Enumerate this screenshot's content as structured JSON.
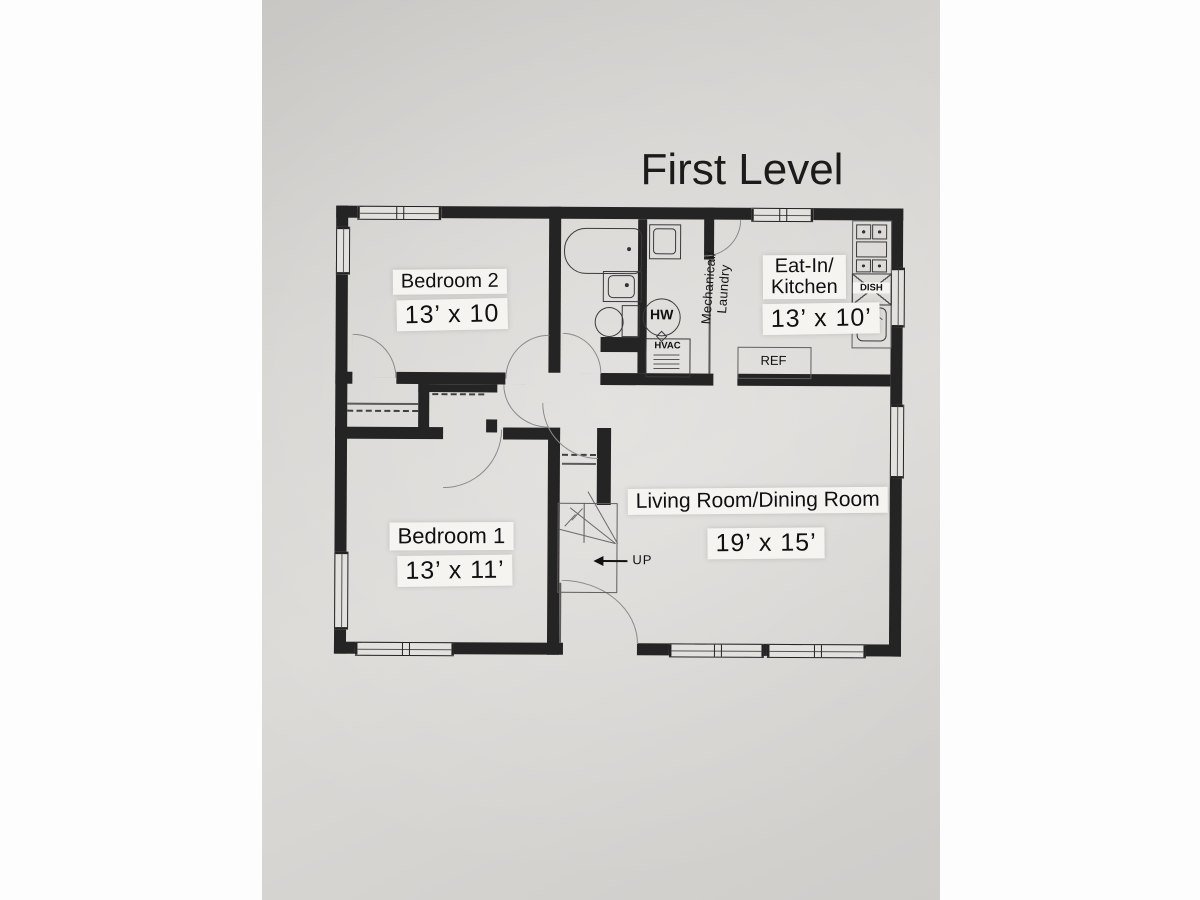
{
  "title": "First Level",
  "rooms": {
    "bedroom2": {
      "name": "Bedroom 2",
      "size": "13’ x 10"
    },
    "bedroom1": {
      "name": "Bedroom 1",
      "size": "13’ x 11’"
    },
    "kitchen": {
      "name_line1": "Eat-In/",
      "name_line2": "Kitchen",
      "size": "13’ x 10’"
    },
    "living": {
      "name": "Living Room/Dining Room",
      "size": "19’ x 15’"
    },
    "mechanical": {
      "line1": "Mechanical/",
      "line2": "Laundry"
    }
  },
  "fixtures": {
    "water_heater": "HW",
    "hvac": "HVAC",
    "dishwasher": "DISH",
    "refrigerator": "REF"
  },
  "stairs": {
    "label": "UP"
  },
  "colors": {
    "wall": "#242424",
    "paper": "#d6d4d1",
    "fixture_line": "#3a3a3a",
    "door_arc": "#8a8a8a",
    "label_bg": "#f5f4f1"
  }
}
